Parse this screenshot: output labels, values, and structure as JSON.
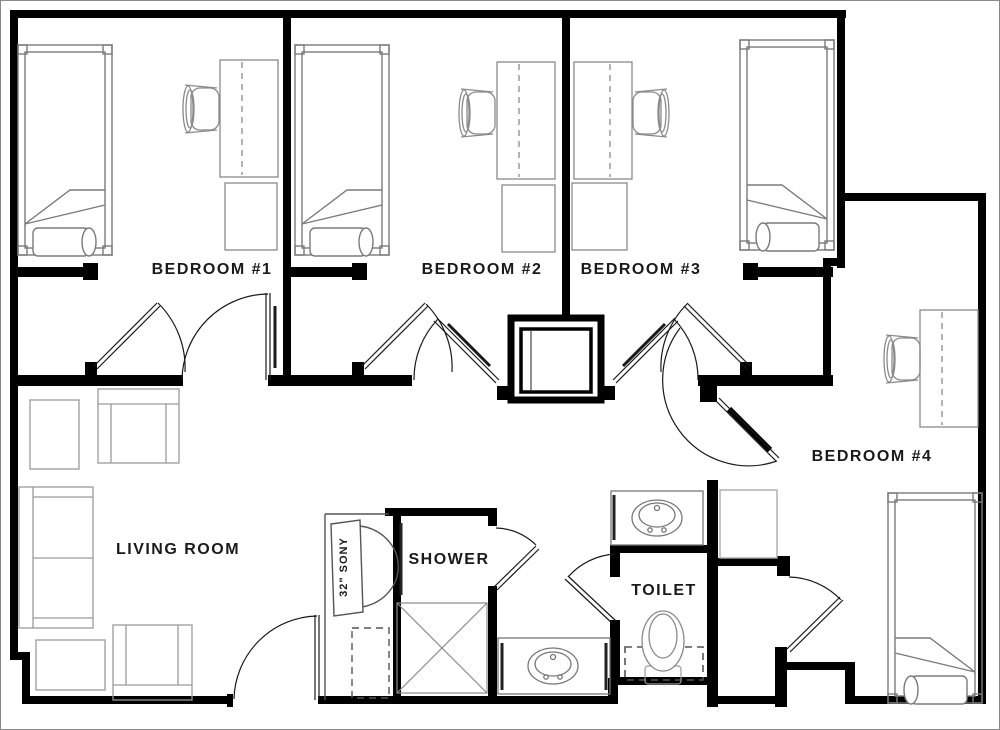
{
  "labels": {
    "bedroom1": "BEDROOM #1",
    "bedroom2": "BEDROOM #2",
    "bedroom3": "BEDROOM #3",
    "bedroom4": "BEDROOM #4",
    "living_room": "LIVING ROOM",
    "shower": "SHOWER",
    "toilet": "TOILET",
    "tv": "32\" SONY"
  },
  "colors": {
    "wall": "#000000",
    "furniture": "#8a8a8a",
    "fixture": "#777777",
    "light": "#a0a0a0",
    "background": "#ffffff",
    "text": "#1a1a1a"
  },
  "fixtures": [
    "bed",
    "desk",
    "desk-chair",
    "dresser",
    "closet",
    "sofa",
    "armchair",
    "side-table",
    "crt-tv",
    "shower-stall",
    "bathroom-sink",
    "toilet-fixture",
    "door-swing"
  ]
}
